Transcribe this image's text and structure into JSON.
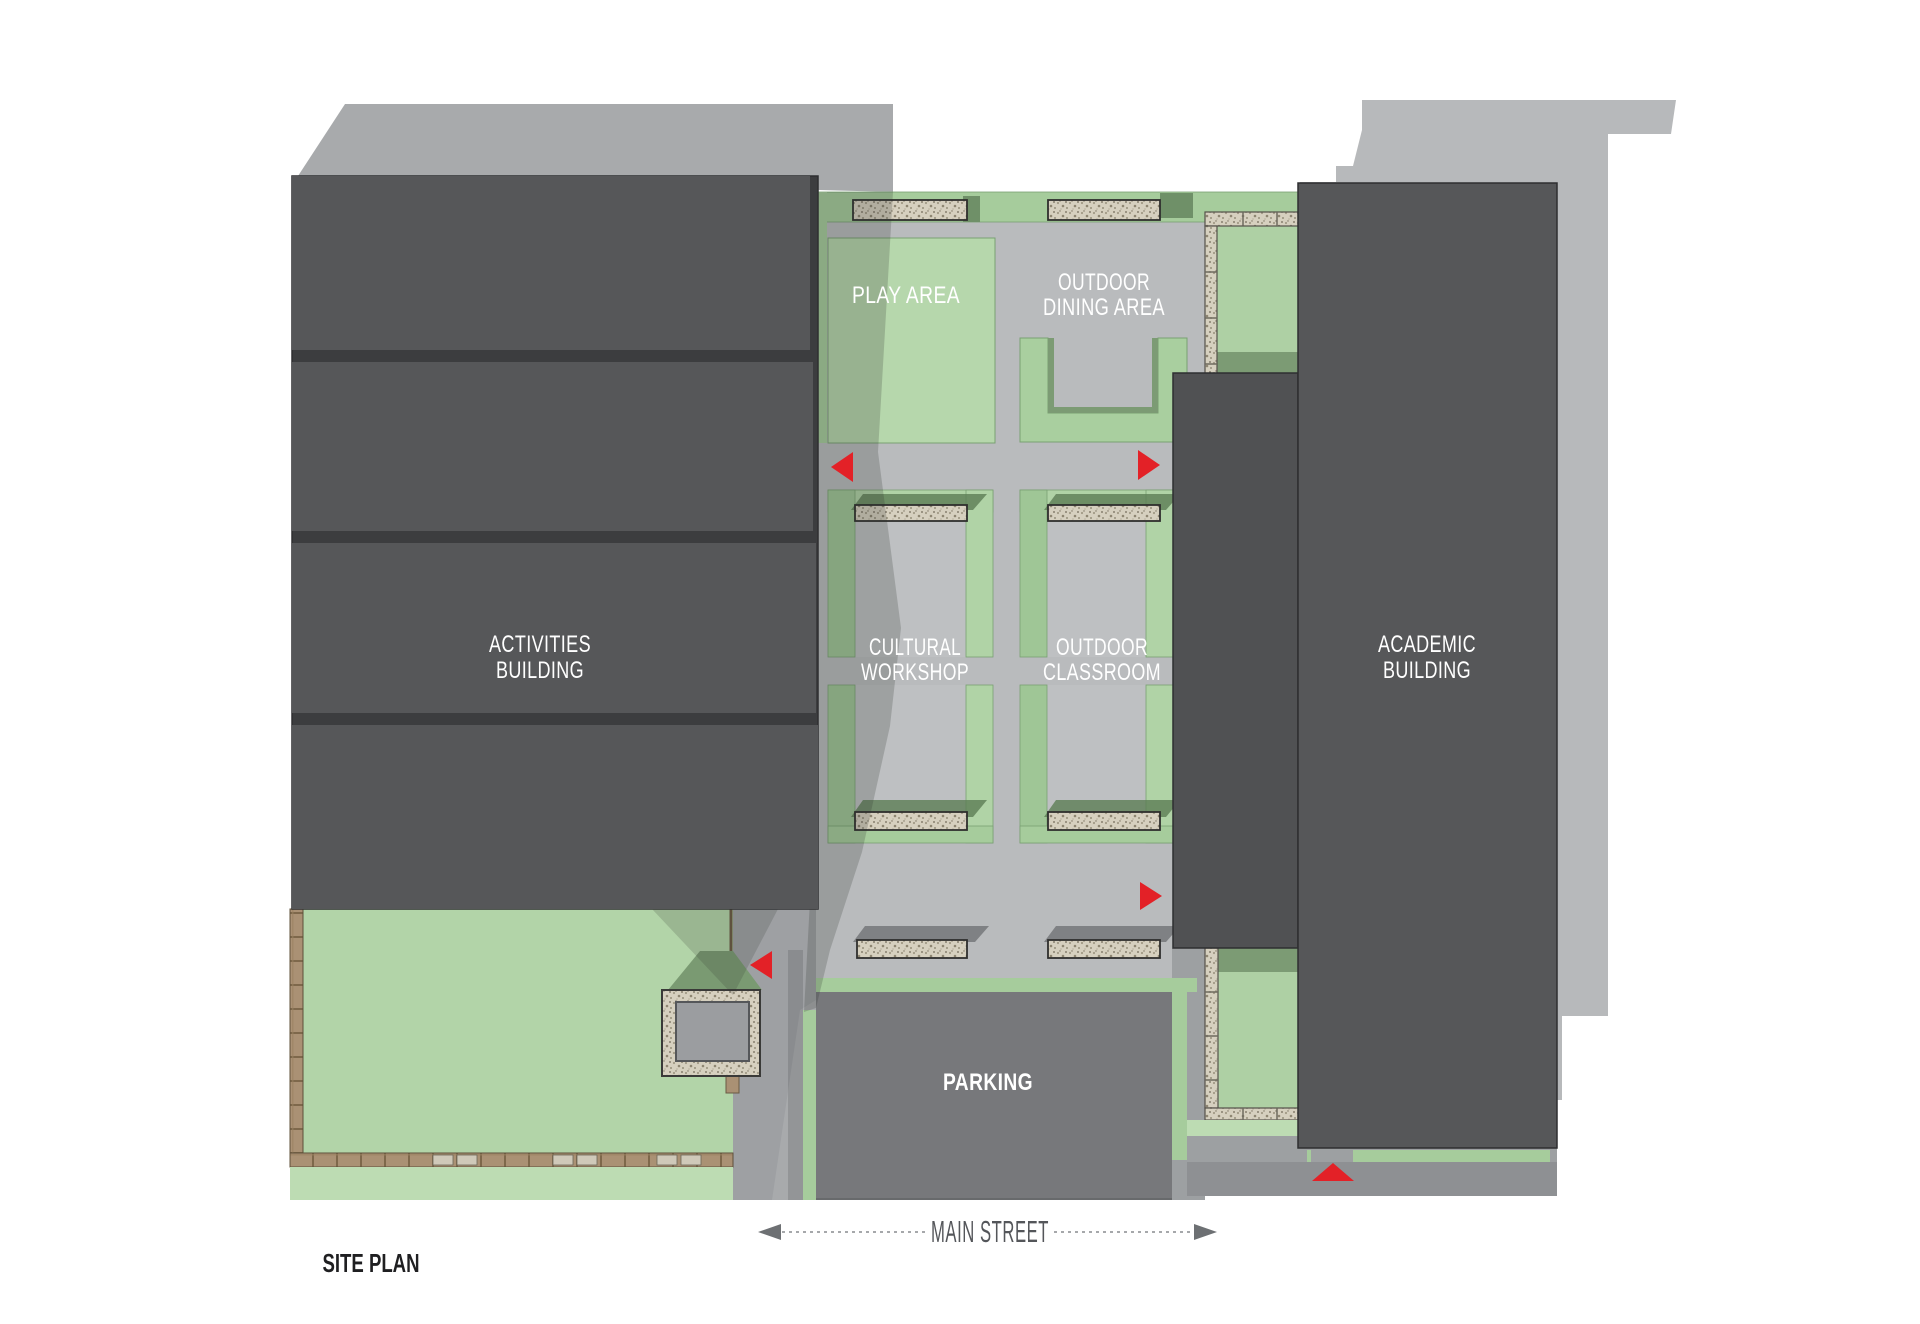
{
  "page_title": "SITE PLAN",
  "plan": {
    "legend_title": "SITE PLAN",
    "street": {
      "label": "MAIN STREET"
    },
    "buildings": {
      "activities": {
        "line1": "ACTIVITIES",
        "line2": "BUILDING"
      },
      "academic": {
        "line1": "ACADEMIC",
        "line2": "BUILDING"
      }
    },
    "areas": {
      "play": {
        "label": "PLAY AREA"
      },
      "dining": {
        "line1": "OUTDOOR",
        "line2": "DINING AREA"
      },
      "workshop": {
        "line1": "CULTURAL",
        "line2": "WORKSHOP"
      },
      "classroom": {
        "line1": "OUTDOOR",
        "line2": "CLASSROOM"
      },
      "parking": {
        "label": "PARKING"
      }
    },
    "entrance_arrows": [
      {
        "id": "courtyard-west-upper",
        "direction": "left"
      },
      {
        "id": "courtyard-east-upper",
        "direction": "right"
      },
      {
        "id": "courtyard-east-lower",
        "direction": "right"
      },
      {
        "id": "lawn-driveway",
        "direction": "left"
      },
      {
        "id": "main-street-entry",
        "direction": "up"
      }
    ],
    "colors": {
      "building_dark": "#565759",
      "building_gap": "#3c3d3f",
      "courtyard_gray": "#b9bbbd",
      "parking_gray": "#77787b",
      "walk_gray": "#9da0a2",
      "lawn_green": "#b2d4a8",
      "band_green": "#a6cc9c",
      "garden_green": "#aed0a4",
      "shadow_green": "#7c9b74",
      "stone": "#d6d0bf",
      "wood": "#aa9174",
      "shadow_gray_left": "#a8aaac",
      "shadow_gray_right": "#b7b9bb",
      "arrow_red": "#e32127",
      "street_text": "#54565a"
    }
  }
}
